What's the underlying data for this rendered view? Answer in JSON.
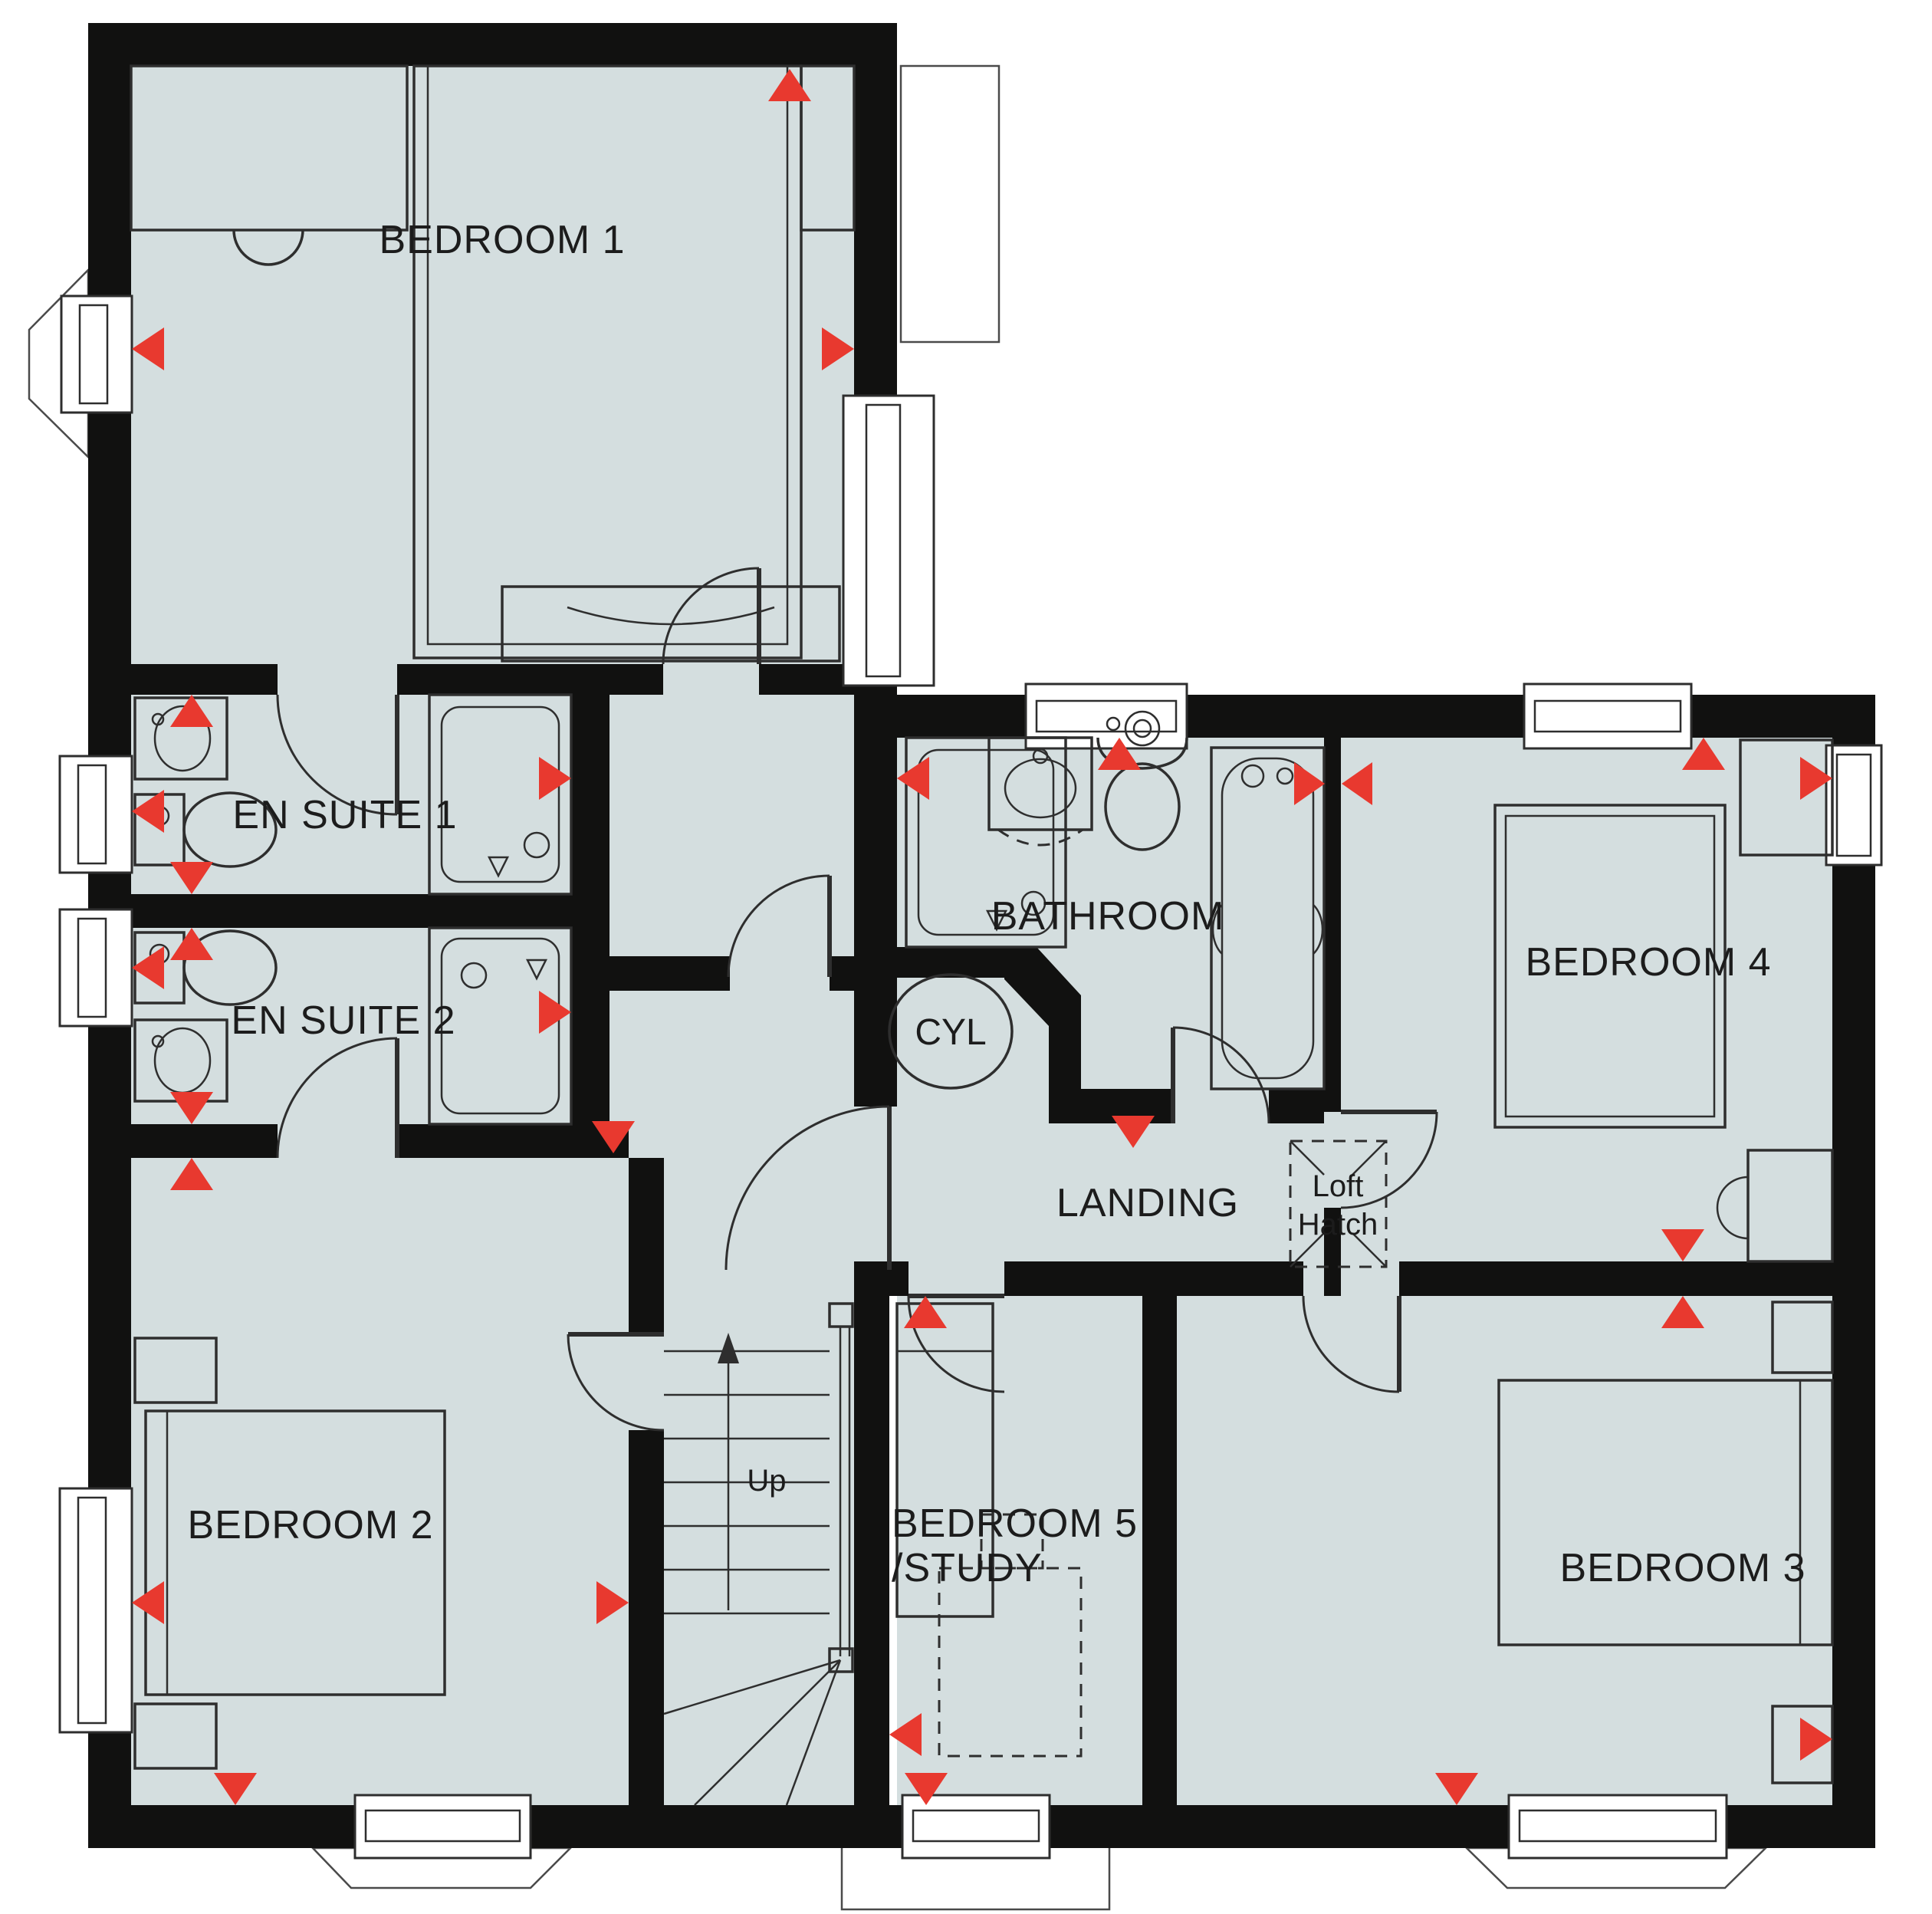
{
  "floorplan": {
    "type": "first-floor house floor plan",
    "rooms": [
      {
        "id": "bedroom-1",
        "label": "BEDROOM 1"
      },
      {
        "id": "en-suite-1",
        "label": "EN SUITE 1"
      },
      {
        "id": "en-suite-2",
        "label": "EN SUITE 2"
      },
      {
        "id": "bedroom-2",
        "label": "BEDROOM 2"
      },
      {
        "id": "bathroom",
        "label": "BATHROOM"
      },
      {
        "id": "landing",
        "label": "LANDING"
      },
      {
        "id": "bedroom-4",
        "label": "BEDROOM 4"
      },
      {
        "id": "bedroom-3",
        "label": "BEDROOM 3"
      },
      {
        "id": "bedroom-5-study",
        "label_line1": "BEDROOM 5",
        "label_line2": "/STUDY"
      }
    ],
    "features": {
      "cylinder": "CYL",
      "loft_hatch_line1": "Loft",
      "loft_hatch_line2": "Hatch",
      "stairs_direction": "Up"
    },
    "colors": {
      "floor_fill": "#d4dedf",
      "wall": "#111110",
      "marker_red": "#e8392f",
      "outline": "#2e2e2e",
      "window_fill": "#ffffff"
    }
  }
}
